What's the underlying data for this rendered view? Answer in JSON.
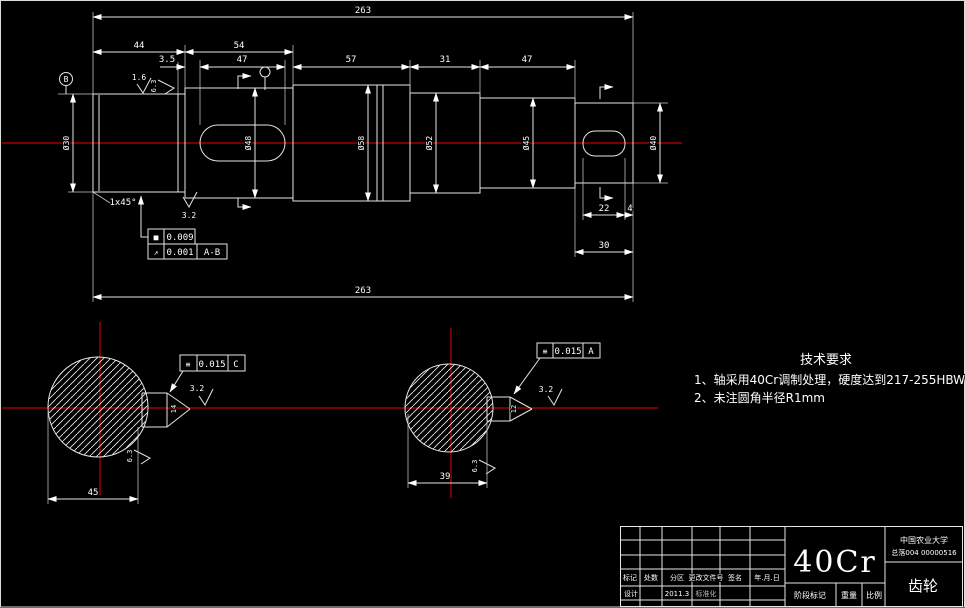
{
  "drawing": {
    "main": {
      "dim_total_top": "263",
      "dim_total_bottom": "263",
      "dim_44": "44",
      "dim_54": "54",
      "dim_35": "3.5",
      "dim_47_key": "47",
      "dim_57": "57",
      "dim_31": "31",
      "dim_47b": "47",
      "dim_22": "22",
      "dim_4": "4",
      "dim_30": "30",
      "dia_labels": [
        "Ø30",
        "Ø48",
        "Ø58",
        "Ø52",
        "Ø45"
      ],
      "dia_right": "Ø40",
      "datum_b": "B",
      "rough_16": "1.6",
      "rough_63": "6.3",
      "rough_32_shoulder": "3.2",
      "chamfer": "1x45°",
      "tol_cyl": {
        "sym": "■",
        "val": "0.009"
      },
      "tol_runout": {
        "sym": "↗",
        "val": "0.001",
        "datum": "A-B"
      }
    },
    "section_left": {
      "tol_sym": "≡",
      "tol_val": "0.015",
      "tol_datum": "C",
      "rough": "3.2",
      "rough_side": "6.3",
      "key_dim": "14",
      "dim_width": "45"
    },
    "section_right": {
      "tol_sym": "≡",
      "tol_val": "0.015",
      "tol_datum": "A",
      "rough": "3.2",
      "rough_side": "6.3",
      "key_dim": "12",
      "dim_width": "39"
    },
    "tech_req": {
      "title": "技术要求",
      "line1": "1、轴采用40Cr调制处理，硬度达到217-255HBW",
      "line2": "2、未注圆角半径R1mm"
    },
    "title_block": {
      "material": "40Cr",
      "part_name": "齿轮",
      "org": "中国农业大学",
      "org_sub": "总落004 00000516",
      "col_labels": [
        "标记",
        "处数",
        "分区",
        "更改文件号",
        "签名",
        "年.月.日"
      ],
      "row2": {
        "c1": "设计",
        "c3": "2011.3",
        "c4": "标准化"
      },
      "bottom_labels": [
        "阶段标记",
        "重量",
        "比例"
      ]
    }
  }
}
